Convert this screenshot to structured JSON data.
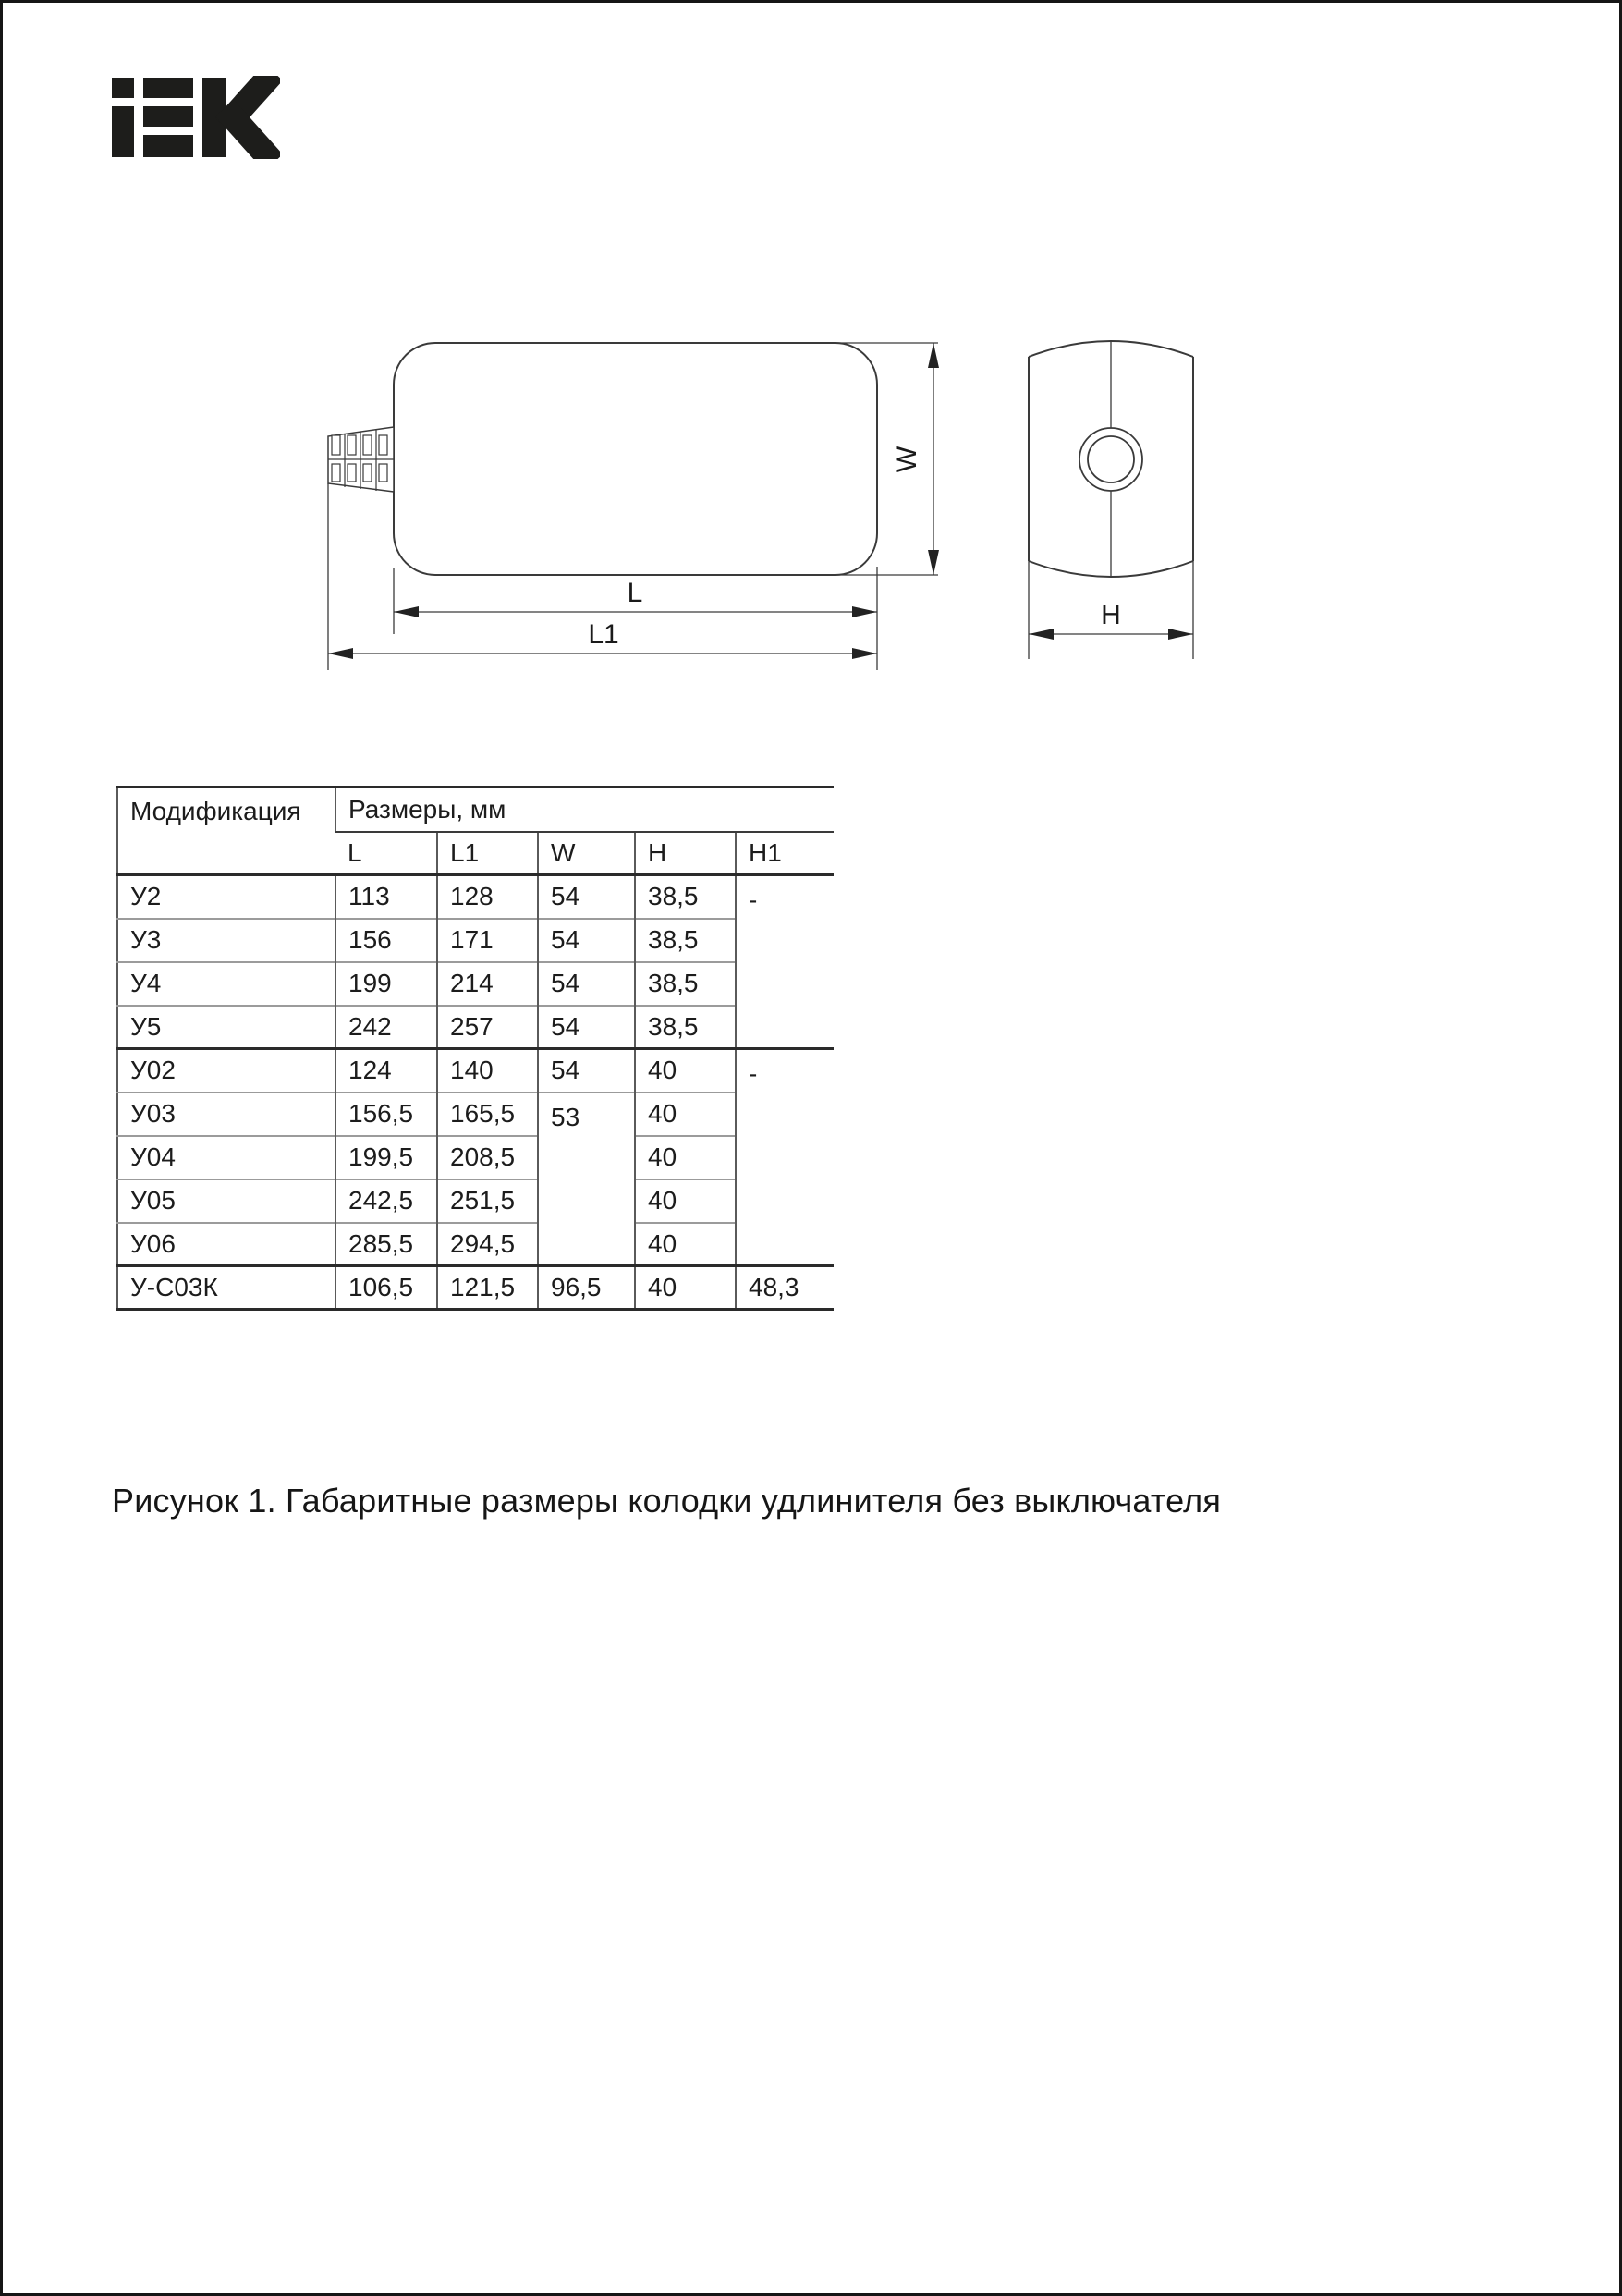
{
  "page": {
    "background": "#ffffff",
    "frame_color": "#161616"
  },
  "logo": {
    "name": "IEK",
    "color": "#1d1d1b"
  },
  "drawing": {
    "line_color": "#3a3a3a",
    "dim_labels": {
      "l": "L",
      "l1": "L1",
      "w": "W",
      "h": "H"
    }
  },
  "table": {
    "header": {
      "modification": "Модификация",
      "sizes": "Размеры, мм",
      "columns": [
        "L",
        "L1",
        "W",
        "H",
        "H1"
      ]
    },
    "rows": [
      {
        "mod": "У2",
        "l": "113",
        "l1": "128",
        "w": "54",
        "h": "38,5",
        "h1": "-",
        "h1_rowspan": 4
      },
      {
        "mod": "У3",
        "l": "156",
        "l1": "171",
        "w": "54",
        "h": "38,5"
      },
      {
        "mod": "У4",
        "l": "199",
        "l1": "214",
        "w": "54",
        "h": "38,5"
      },
      {
        "mod": "У5",
        "l": "242",
        "l1": "257",
        "w": "54",
        "h": "38,5"
      },
      {
        "mod": "У02",
        "l": "124",
        "l1": "140",
        "w": "54",
        "h": "40",
        "h1": "-",
        "h1_rowspan": 5,
        "group_start": true
      },
      {
        "mod": "У03",
        "l": "156,5",
        "l1": "165,5",
        "w": "53",
        "w_rowspan": 4,
        "h": "40"
      },
      {
        "mod": "У04",
        "l": "199,5",
        "l1": "208,5",
        "h": "40"
      },
      {
        "mod": "У05",
        "l": "242,5",
        "l1": "251,5",
        "h": "40"
      },
      {
        "mod": "У06",
        "l": "285,5",
        "l1": "294,5",
        "h": "40"
      },
      {
        "mod": "У-С03К",
        "l": "106,5",
        "l1": "121,5",
        "w": "96,5",
        "h": "40",
        "h1": "48,3",
        "group_start": true
      }
    ]
  },
  "caption": "Рисунок 1. Габаритные размеры колодки удлинителя без выключателя"
}
